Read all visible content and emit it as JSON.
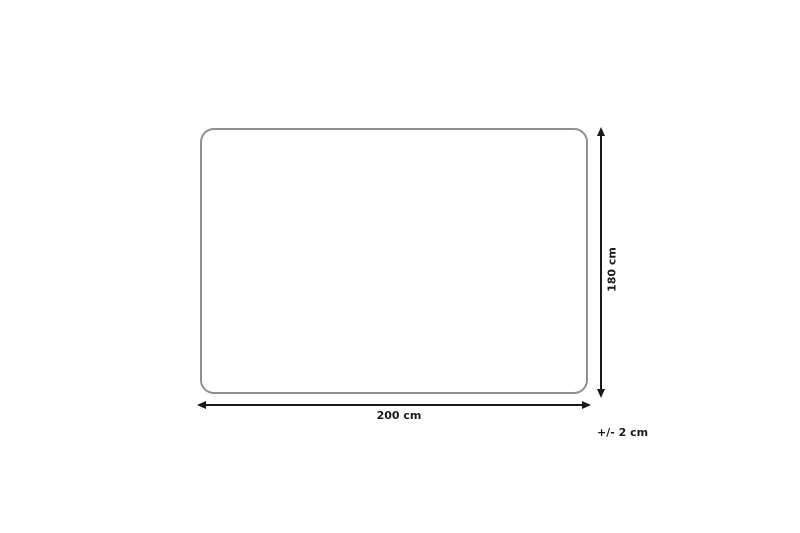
{
  "diagram": {
    "type": "product-dimension-diagram",
    "shape": "rounded-rectangle",
    "width": {
      "label": "200 cm"
    },
    "height": {
      "label": "180 cm"
    },
    "tolerance": {
      "label": "+/- 2 cm"
    },
    "colors": {
      "background": "#ffffff",
      "outline": "#8f8f8f",
      "dimension_lines": "#1a1a1a",
      "text": "#1a1a1a"
    }
  }
}
